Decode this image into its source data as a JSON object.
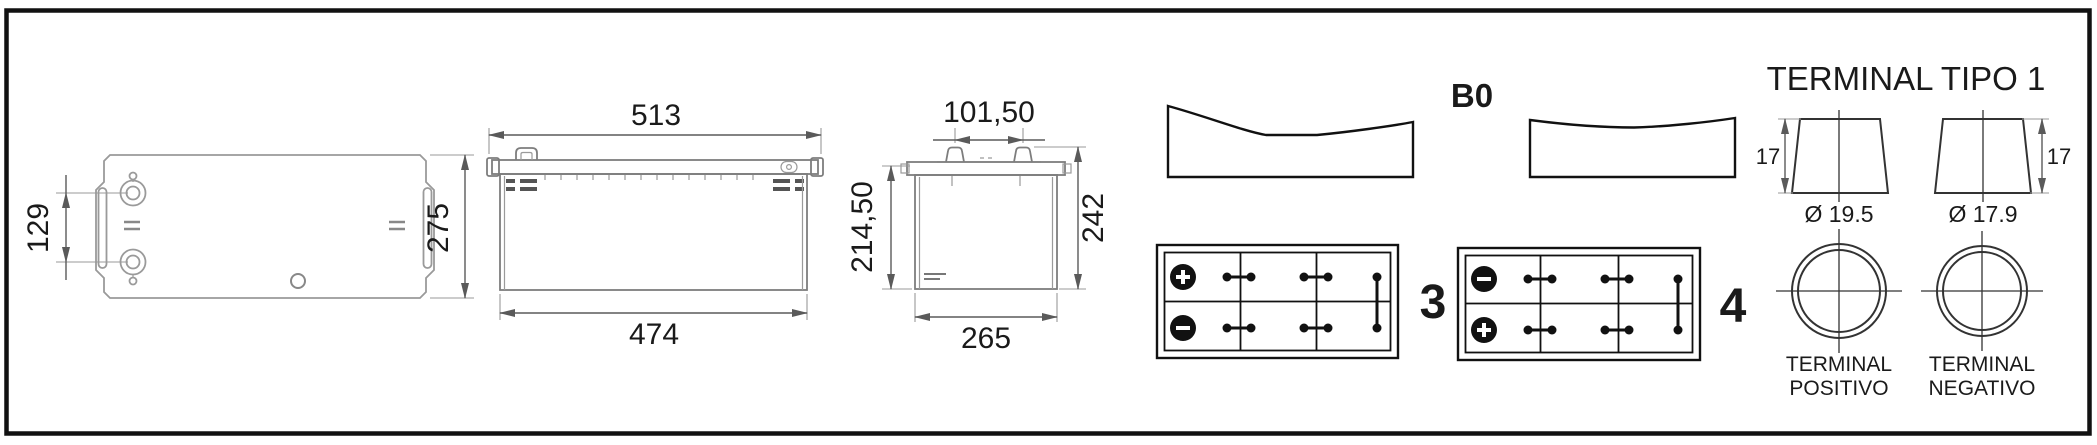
{
  "top_view": {
    "terminal_spacing": "129",
    "overall_width": "275"
  },
  "front_view": {
    "overall_length": "513",
    "base_length": "474"
  },
  "end_view": {
    "terminal_spacing": "101,50",
    "box_height": "214,50",
    "total_height": "242",
    "overall_depth": "265"
  },
  "holddown": {
    "label": "B0"
  },
  "polarity": {
    "layout_left_label": "3",
    "layout_right_label": "4"
  },
  "terminal": {
    "title": "TERMINAL TIPO 1",
    "positive_height": "17",
    "negative_height": "17",
    "positive_diameter": "Ø 19.5",
    "negative_diameter": "Ø 17.9",
    "positive_line1": "TERMINAL",
    "positive_line2": "POSITIVO",
    "negative_line1": "TERMINAL",
    "negative_line2": "NEGATIVO"
  },
  "colors": {
    "frame": "#111111",
    "drawing_light": "#9a9a9a",
    "drawing_mid": "#7d7d7d",
    "ink": "#111111",
    "background": "#ffffff"
  }
}
